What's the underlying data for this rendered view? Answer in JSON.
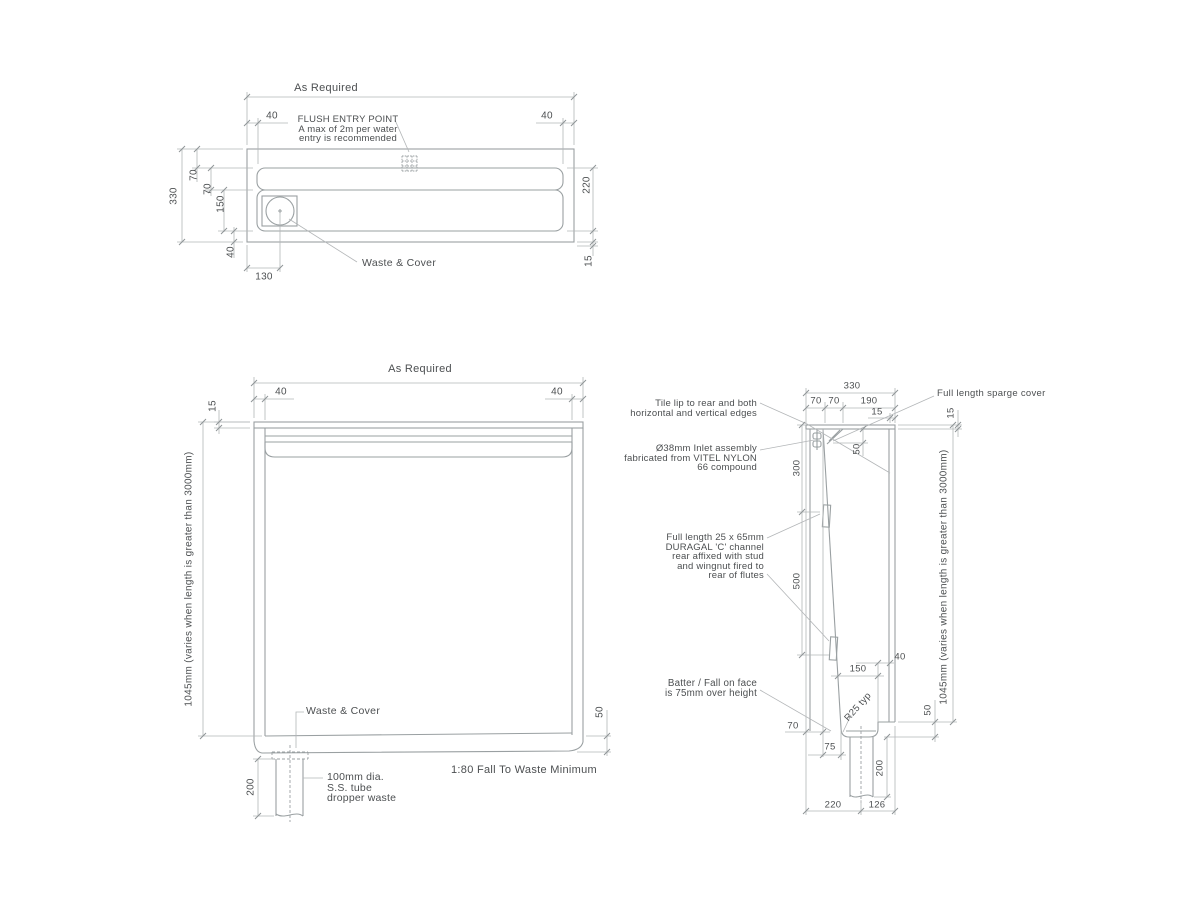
{
  "colors": {
    "object_line": "#9aa0a2",
    "dim_line": "#b3b6b8",
    "text": "#4c4f51",
    "background": "#ffffff"
  },
  "plan": {
    "as_required": "As Required",
    "inset_left": "40",
    "inset_right": "40",
    "flush_note": [
      "FLUSH ENTRY POINT",
      "A max of 2m per water",
      "entry is recommended"
    ],
    "depth_total": "330",
    "d70a": "70",
    "d70b": "70",
    "d150": "150",
    "d40_bottom": "40",
    "d220": "220",
    "d15": "15",
    "d130": "130",
    "waste_label": "Waste & Cover"
  },
  "front": {
    "as_required": "As Required",
    "inset_left": "40",
    "inset_right": "40",
    "lip15": "15",
    "height_label": "1045mm (varies when length is greater than 3000mm)",
    "waste_label": "Waste & Cover",
    "d200": "200",
    "dropper_note": [
      "100mm dia.",
      "S.S. tube",
      "dropper waste"
    ],
    "d50": "50",
    "fall_note": "1:80 Fall To Waste Minimum"
  },
  "side": {
    "w330": "330",
    "w70a": "70",
    "w70b": "70",
    "w190": "190",
    "d15_top": "15",
    "d15_right": "15",
    "sparge_label": "Full length sparge cover",
    "tile_note": [
      "Tile lip to rear and both",
      "horizontal and vertical edges"
    ],
    "inlet_note": [
      "Ø38mm Inlet assembly",
      "fabricated from VITEL NYLON",
      "66 compound"
    ],
    "d300": "300",
    "d50_sparge": "50",
    "d500": "500",
    "channel_note": [
      "Full length 25 x 65mm",
      "DURAGAL 'C' channel",
      "rear affixed with stud",
      "and wingnut fired to",
      "rear of flutes"
    ],
    "batter_note": [
      "Batter / Fall on face",
      "is 75mm over height"
    ],
    "d40": "40",
    "d150": "150",
    "radius_note": "R25 typ",
    "d70": "70",
    "d75": "75",
    "d50_bottom": "50",
    "d200": "200",
    "d220": "220",
    "d126": "126",
    "height_label": "1045mm (varies when length is greater than 3000mm)"
  }
}
